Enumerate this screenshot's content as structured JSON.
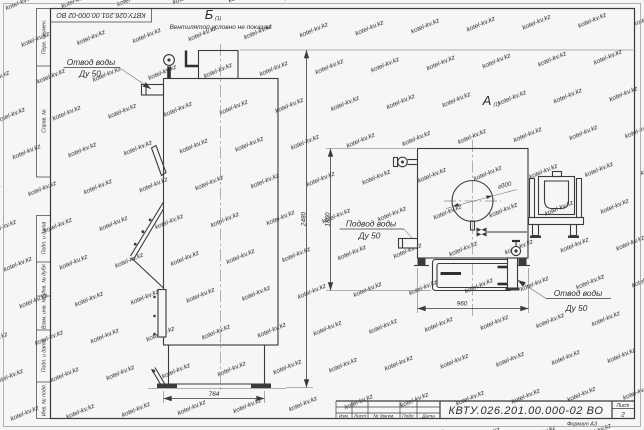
{
  "watermark": {
    "text": "kotel-kv.kz"
  },
  "frame": {
    "top_stamp": "КВТУ.026.201.00.000-02  ВО",
    "left_labels": [
      "Перв. примен.",
      "Справ. №",
      "Подп. и дата",
      "Инв. № дубл.",
      "Взам. инв. №",
      "Подп. и дата",
      "Инв. № подл."
    ],
    "format_note": "Формат А3"
  },
  "title_block": {
    "doc_number": "КВТУ.026.201.00.000-02  ВО",
    "columns": [
      "Изм.",
      "Лист",
      "№ докум.",
      "Подп.",
      "Дата"
    ],
    "sheet_label": "Лист",
    "sheet_number": "2"
  },
  "views": {
    "side": {
      "label": "Б",
      "label_index": "(1)",
      "note": "Вентилятор условно не показан",
      "outlet_line1": "Отвод воды",
      "outlet_line2": "Ду 50",
      "dim_height": "2480",
      "dim_width": "764"
    },
    "front": {
      "label": "А",
      "label_index": "(1)",
      "inlet_line1": "Подвод воды",
      "inlet_line2": "Ду 50",
      "outlet_line1": "Отвод воды",
      "outlet_line2": "Ду 50",
      "dim_height": "1850",
      "dim_width": "960",
      "dim_diameter": "⌀300"
    }
  }
}
